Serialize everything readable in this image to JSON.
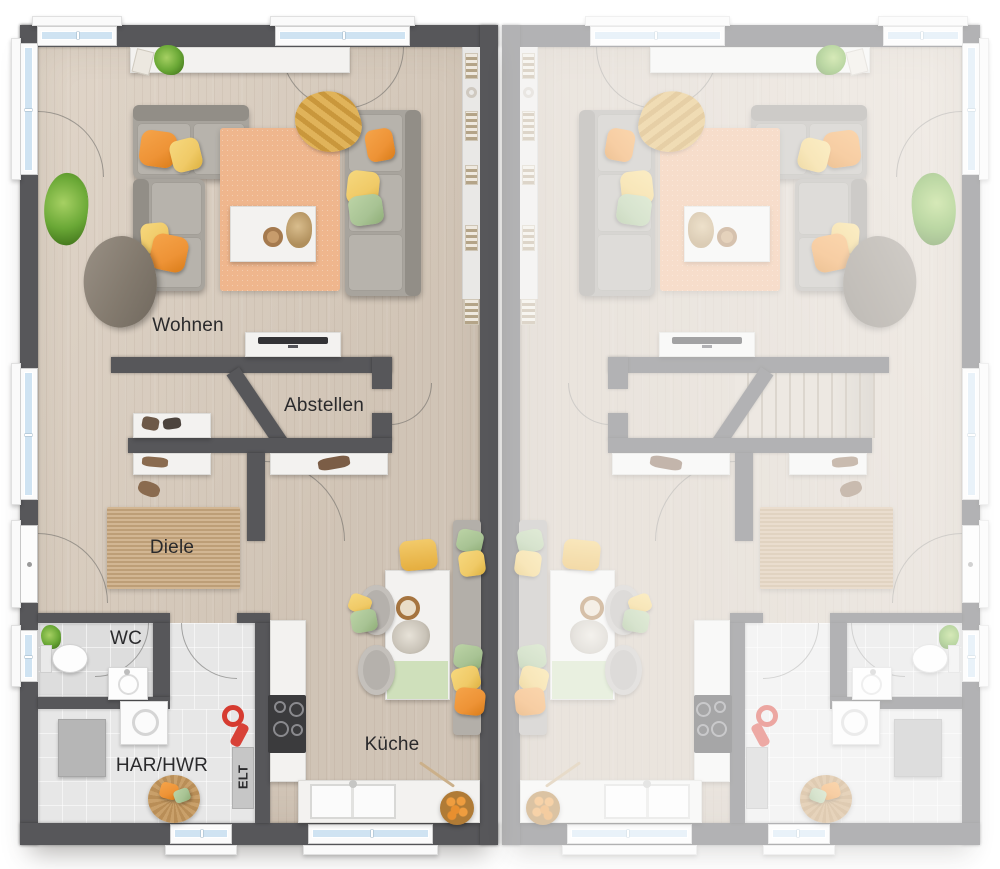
{
  "plan_type": "residential-floorplan-duplex",
  "rooms": [
    {
      "key": "wohnen",
      "label": "Wohnen"
    },
    {
      "key": "abstellen",
      "label": "Abstellen"
    },
    {
      "key": "diele",
      "label": "Diele"
    },
    {
      "key": "wc",
      "label": "WC"
    },
    {
      "key": "har_hwr",
      "label": "HAR/HWR"
    },
    {
      "key": "elt",
      "label": "ELT"
    },
    {
      "key": "kueche",
      "label": "Küche"
    }
  ],
  "colors": {
    "wall": "#57575a",
    "wood_floor": "#d9ccbd",
    "tile_floor": "#e7e7e7",
    "living_rug": "#efb68d",
    "jute_rug": "#c9a87e",
    "window_glass": "#cfe3f2",
    "sofa_gray": "#a8a49d",
    "accent_orange": "#ee9336",
    "accent_yellow": "#f0ca67",
    "accent_green": "#a8c394",
    "shelf_white": "#f3f2f0",
    "label_text": "#2a2a2c"
  }
}
